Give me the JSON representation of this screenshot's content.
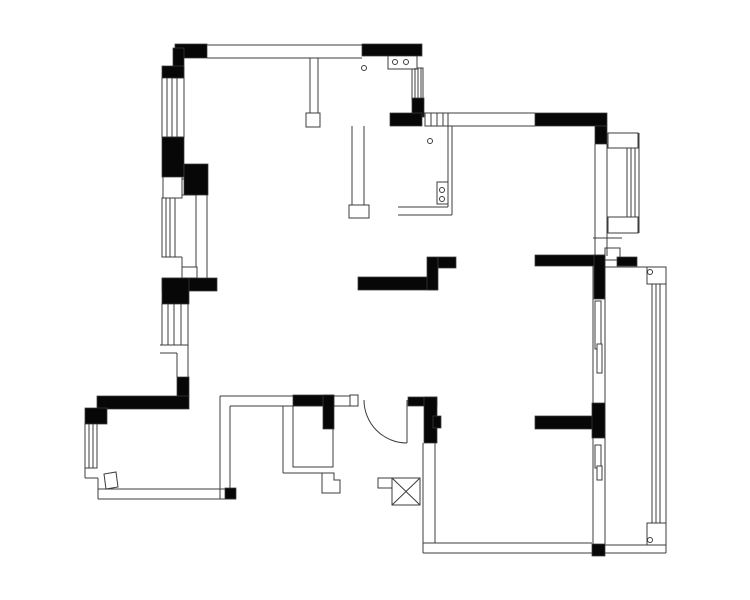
{
  "meta": {
    "description": "Black-and-white architectural floor plan drawing (CAD export). No visible text, dimensions or labels — only wall, window, door and fixture linework.",
    "colors": {
      "background": "#ffffff",
      "wall_fill": "#070707",
      "line_color": "#3c3c3c"
    },
    "canvas": {
      "width": 750,
      "height": 600
    }
  },
  "plan": {
    "wall_rects": [
      [
        175,
        44,
        32,
        14
      ],
      [
        173,
        48,
        11,
        30
      ],
      [
        162,
        66,
        22,
        12
      ],
      [
        162,
        137,
        22,
        40
      ],
      [
        184,
        164,
        24,
        31
      ],
      [
        162,
        278,
        55,
        13
      ],
      [
        162,
        278,
        27,
        26
      ],
      [
        177,
        377,
        12,
        20
      ],
      [
        97,
        396,
        92,
        13
      ],
      [
        85,
        408,
        22,
        16
      ],
      [
        225,
        488,
        11,
        11
      ],
      [
        362,
        44,
        60,
        12
      ],
      [
        412,
        98,
        12,
        19
      ],
      [
        390,
        113,
        32,
        13
      ],
      [
        535,
        113,
        72,
        13
      ],
      [
        595,
        126,
        12,
        18
      ],
      [
        358,
        277,
        79,
        13
      ],
      [
        427,
        257,
        11,
        33
      ],
      [
        438,
        257,
        18,
        11
      ],
      [
        535,
        255,
        70,
        11
      ],
      [
        594,
        255,
        11,
        44
      ],
      [
        617,
        257,
        20,
        9
      ],
      [
        293,
        395,
        41,
        11
      ],
      [
        323,
        395,
        11,
        34
      ],
      [
        408,
        397,
        29,
        9
      ],
      [
        424,
        397,
        13,
        46
      ],
      [
        433,
        416,
        8,
        12
      ],
      [
        535,
        416,
        62,
        13
      ],
      [
        592,
        403,
        13,
        35
      ],
      [
        592,
        544,
        13,
        12
      ]
    ],
    "white_rects": [
      [
        162,
        77,
        22,
        60
      ],
      [
        162,
        198,
        13,
        59
      ],
      [
        162,
        303,
        26,
        42
      ],
      [
        85,
        423,
        12,
        45
      ],
      [
        425,
        113,
        23,
        13
      ],
      [
        412,
        68,
        11,
        32
      ],
      [
        163,
        176,
        19,
        22
      ],
      [
        182,
        179,
        15,
        16
      ],
      [
        182,
        267,
        15,
        11
      ],
      [
        306,
        113,
        14,
        14
      ],
      [
        349,
        205,
        20,
        13
      ],
      [
        350,
        395,
        8,
        11
      ],
      [
        605,
        248,
        15,
        12
      ],
      [
        608,
        133,
        30,
        15
      ],
      [
        608,
        217,
        30,
        16
      ],
      [
        647,
        267,
        19,
        17
      ],
      [
        647,
        523,
        19,
        22
      ],
      [
        388,
        55,
        29,
        14
      ],
      [
        437,
        182,
        11,
        22
      ],
      [
        392,
        478,
        28,
        27
      ],
      [
        378,
        478,
        14,
        10
      ],
      [
        595,
        301,
        6,
        48
      ],
      [
        597,
        344,
        5,
        29
      ],
      [
        595,
        445,
        6,
        23
      ],
      [
        597,
        466,
        5,
        14
      ],
      [
        293,
        406,
        40,
        61
      ]
    ],
    "lines": [
      [
        175,
        45,
        422,
        45
      ],
      [
        207,
        58,
        362,
        58
      ],
      [
        310,
        58,
        310,
        113
      ],
      [
        318,
        58,
        318,
        113
      ],
      [
        196,
        195,
        196,
        267
      ],
      [
        207,
        195,
        207,
        278
      ],
      [
        162,
        257,
        182,
        257
      ],
      [
        182,
        257,
        182,
        267
      ],
      [
        160,
        345,
        188,
        345
      ],
      [
        160,
        353,
        177,
        353
      ],
      [
        177,
        353,
        177,
        377
      ],
      [
        188,
        345,
        188,
        377
      ],
      [
        85,
        468,
        97,
        468
      ],
      [
        85,
        468,
        85,
        478
      ],
      [
        85,
        478,
        98,
        478
      ],
      [
        98,
        478,
        98,
        499
      ],
      [
        98,
        489,
        225,
        489
      ],
      [
        98,
        499,
        236,
        499
      ],
      [
        97,
        409,
        97,
        423
      ],
      [
        220,
        396,
        220,
        499
      ],
      [
        230,
        406,
        230,
        488
      ],
      [
        220,
        396,
        350,
        396
      ],
      [
        230,
        406,
        293,
        406
      ],
      [
        334,
        406,
        350,
        406
      ],
      [
        283,
        406,
        283,
        473
      ],
      [
        283,
        473,
        322,
        473
      ],
      [
        423,
        443,
        423,
        553
      ],
      [
        435,
        443,
        435,
        543
      ],
      [
        423,
        543,
        592,
        543
      ],
      [
        423,
        553,
        666,
        553
      ],
      [
        593,
        266,
        593,
        544
      ],
      [
        605,
        266,
        605,
        544
      ],
      [
        423,
        113,
        535,
        113
      ],
      [
        448,
        126,
        535,
        126
      ],
      [
        607,
        144,
        607,
        256
      ],
      [
        595,
        144,
        595,
        255
      ],
      [
        593,
        238,
        622,
        238
      ],
      [
        605,
        267,
        666,
        267
      ],
      [
        666,
        267,
        666,
        553
      ],
      [
        605,
        545,
        650,
        545
      ],
      [
        352,
        126,
        352,
        205
      ],
      [
        364,
        126,
        364,
        205
      ],
      [
        448,
        126,
        448,
        207
      ],
      [
        452,
        126,
        452,
        215
      ],
      [
        398,
        207,
        448,
        207
      ],
      [
        398,
        215,
        452,
        215
      ],
      [
        407,
        400,
        407,
        443
      ],
      [
        627,
        148,
        627,
        217
      ],
      [
        631,
        148,
        631,
        217
      ],
      [
        635,
        148,
        635,
        217
      ],
      [
        639,
        133,
        639,
        233
      ],
      [
        652,
        284,
        652,
        523
      ],
      [
        656,
        284,
        656,
        523
      ],
      [
        660,
        284,
        660,
        523
      ],
      [
        415,
        68,
        415,
        100
      ],
      [
        418,
        68,
        418,
        100
      ],
      [
        421,
        68,
        421,
        100
      ],
      [
        167,
        77,
        167,
        137
      ],
      [
        172,
        77,
        172,
        137
      ],
      [
        177,
        77,
        177,
        137
      ],
      [
        166,
        198,
        166,
        257
      ],
      [
        170,
        198,
        170,
        257
      ],
      [
        168,
        303,
        168,
        345
      ],
      [
        174,
        303,
        174,
        345
      ],
      [
        181,
        303,
        181,
        345
      ],
      [
        89,
        423,
        89,
        468
      ],
      [
        93,
        423,
        93,
        468
      ],
      [
        431,
        113,
        431,
        126
      ],
      [
        437,
        113,
        437,
        126
      ],
      [
        443,
        113,
        443,
        126
      ]
    ],
    "circles": [
      [
        364,
        68,
        2.5
      ],
      [
        395,
        62,
        2.5
      ],
      [
        406,
        62,
        2.5
      ],
      [
        430,
        141,
        2.5
      ],
      [
        442,
        190,
        2.5
      ],
      [
        442,
        199,
        2.5
      ],
      [
        650,
        272,
        2.5
      ],
      [
        650,
        540,
        2.5
      ]
    ],
    "paths": [
      {
        "name": "door-swing-arc",
        "d": "M364,400 A43,43 0 0 0 407,443",
        "fill": "none"
      },
      {
        "name": "duct-cross-symbol",
        "d": "M392,478 L420,505 M420,478 L392,505",
        "fill": "none"
      },
      {
        "name": "entry-door-leaf",
        "d": "M106,489 L104,474 L116,472 L118,487 Z",
        "fill": "#ffffff"
      },
      {
        "name": "shower-step-outline",
        "d": "M322,473 L322,493 L340,493 L340,480 L334,480 L334,473 Z",
        "fill": "none"
      }
    ]
  }
}
